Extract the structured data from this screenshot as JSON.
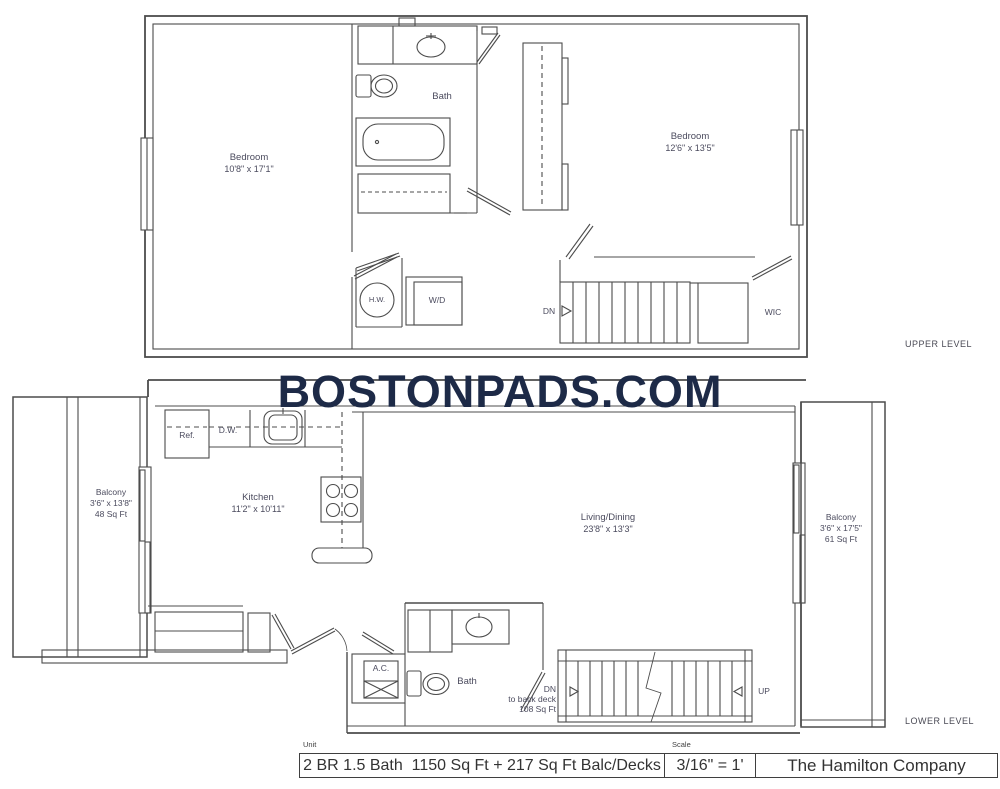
{
  "title": "BOSTONPADS.COM",
  "upper": {
    "level_label": "UPPER LEVEL",
    "bedroom_left": {
      "name": "Bedroom",
      "dims": "10'8\" x 17'1\""
    },
    "bedroom_right": {
      "name": "Bedroom",
      "dims": "12'6\" x 13'5\""
    },
    "bath": "Bath",
    "hw": "H.W.",
    "wd": "W/D",
    "dn": "DN",
    "wic": "WIC"
  },
  "lower": {
    "level_label": "LOWER LEVEL",
    "balcony_left": {
      "name": "Balcony",
      "dims": "3'6\" x 13'8\"",
      "area": "48 Sq Ft"
    },
    "balcony_right": {
      "name": "Balcony",
      "dims": "3'6\" x 17'5\"",
      "area": "61 Sq Ft"
    },
    "kitchen": {
      "name": "Kitchen",
      "dims": "11'2\" x 10'11\""
    },
    "living_dining": {
      "name": "Living/Dining",
      "dims": "23'8\" x 13'3\""
    },
    "ref": "Ref.",
    "dw": "D.W.",
    "ac": "A.C.",
    "bath": "Bath",
    "dn": "DN",
    "dn_dest": "to back deck",
    "dn_area": "108 Sq Ft",
    "up": "UP"
  },
  "footer": {
    "unit_label": "Unit",
    "unit_value": "2 BR 1.5 Bath  1150 Sq Ft + 217 Sq Ft Balc/Decks",
    "scale_label": "Scale",
    "scale_value": "3/16\" = 1'",
    "company": "The Hamilton Company"
  },
  "colors": {
    "wall": "#4c4c4c",
    "label_text": "#4b4b5e",
    "brand": "#1d2a47"
  }
}
